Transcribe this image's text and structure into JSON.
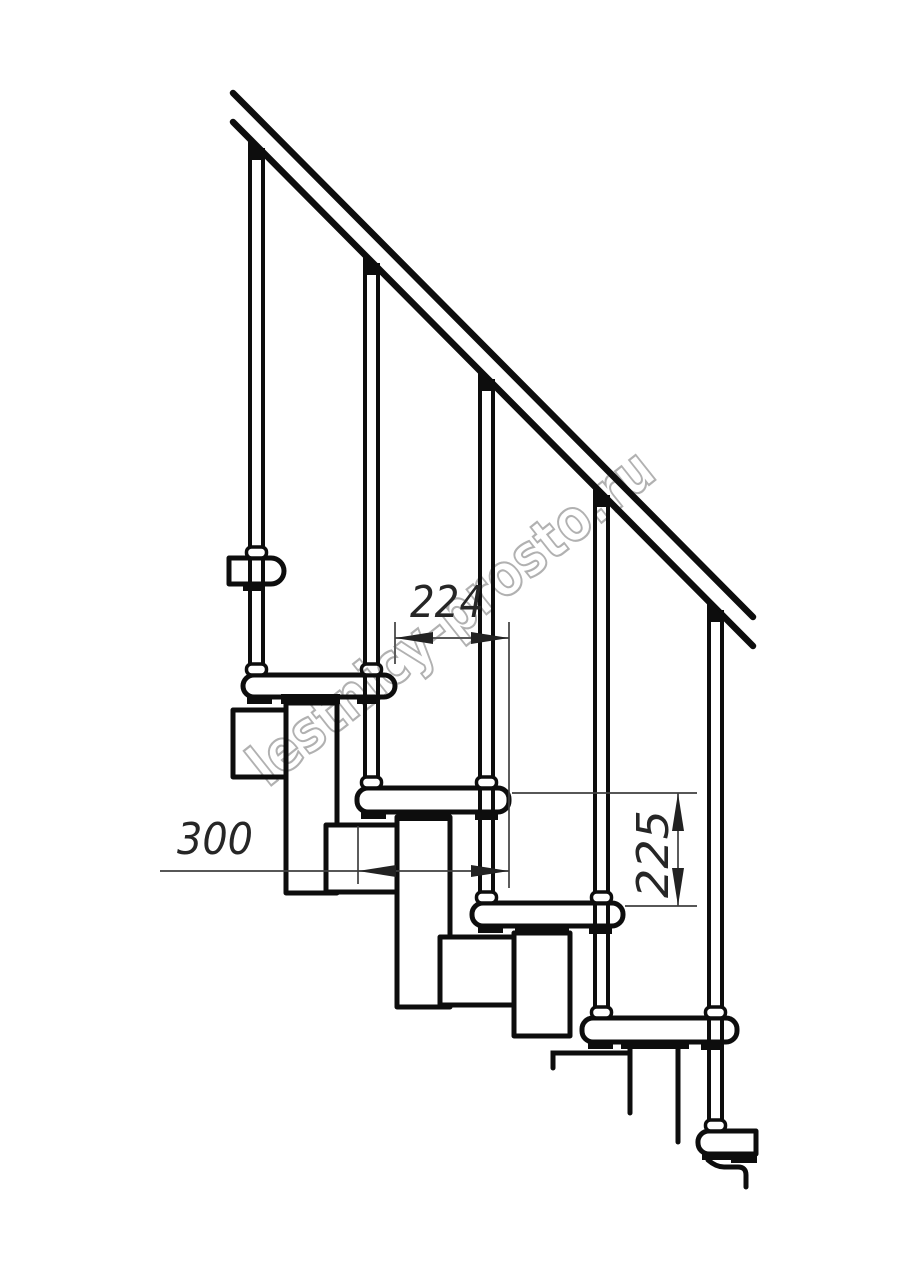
{
  "drawing": {
    "title": "modular staircase side elevation",
    "dimensions": {
      "step_run_mm": "224",
      "tread_depth_mm": "300",
      "step_rise_mm": "225"
    },
    "watermark": {
      "text": "lestnicy-prosto.ru",
      "color": "#9e9e9e"
    },
    "colors": {
      "background": "#ffffff",
      "line": "#0d0d0d",
      "dimension_line": "#3f3f3f",
      "dimension_text": "#262626"
    }
  }
}
